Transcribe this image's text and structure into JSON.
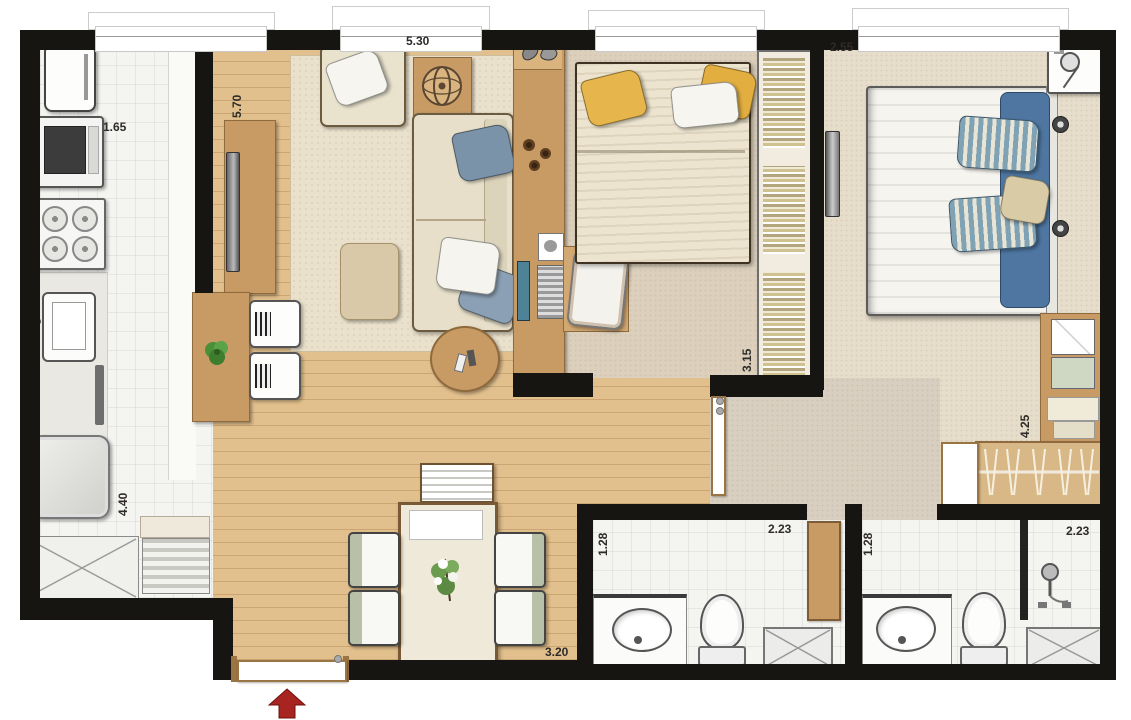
{
  "floorplan": {
    "type": "apartment-floor-plan",
    "entrance_direction": "up"
  },
  "measurements": {
    "kitchen": {
      "width": "1.65",
      "length": "4.40"
    },
    "living_room": {
      "length": "5.70",
      "width": "5.30"
    },
    "bedroom": {
      "length": "3.15"
    },
    "master_bedroom": {
      "width": "2.55",
      "length": "4.25"
    },
    "dining": {
      "width": "3.20"
    },
    "bathroom_1": {
      "length": "1.28",
      "width": "2.23"
    },
    "bathroom_2": {
      "length": "1.28",
      "width": "2.23"
    }
  },
  "colors": {
    "wall": "#171512",
    "wood_floor": "#e2c08d",
    "tile_floor": "#f4f4f1",
    "carpet": "#ddd2c1",
    "furniture_wood": "#c79b63",
    "entrance_arrow": "#a82420",
    "plant": "#4f9b3c",
    "pillow_yellow": "#e6b64c",
    "pillow_blue": "#7fa3b5",
    "blanket_blue": "#4e76a1"
  }
}
